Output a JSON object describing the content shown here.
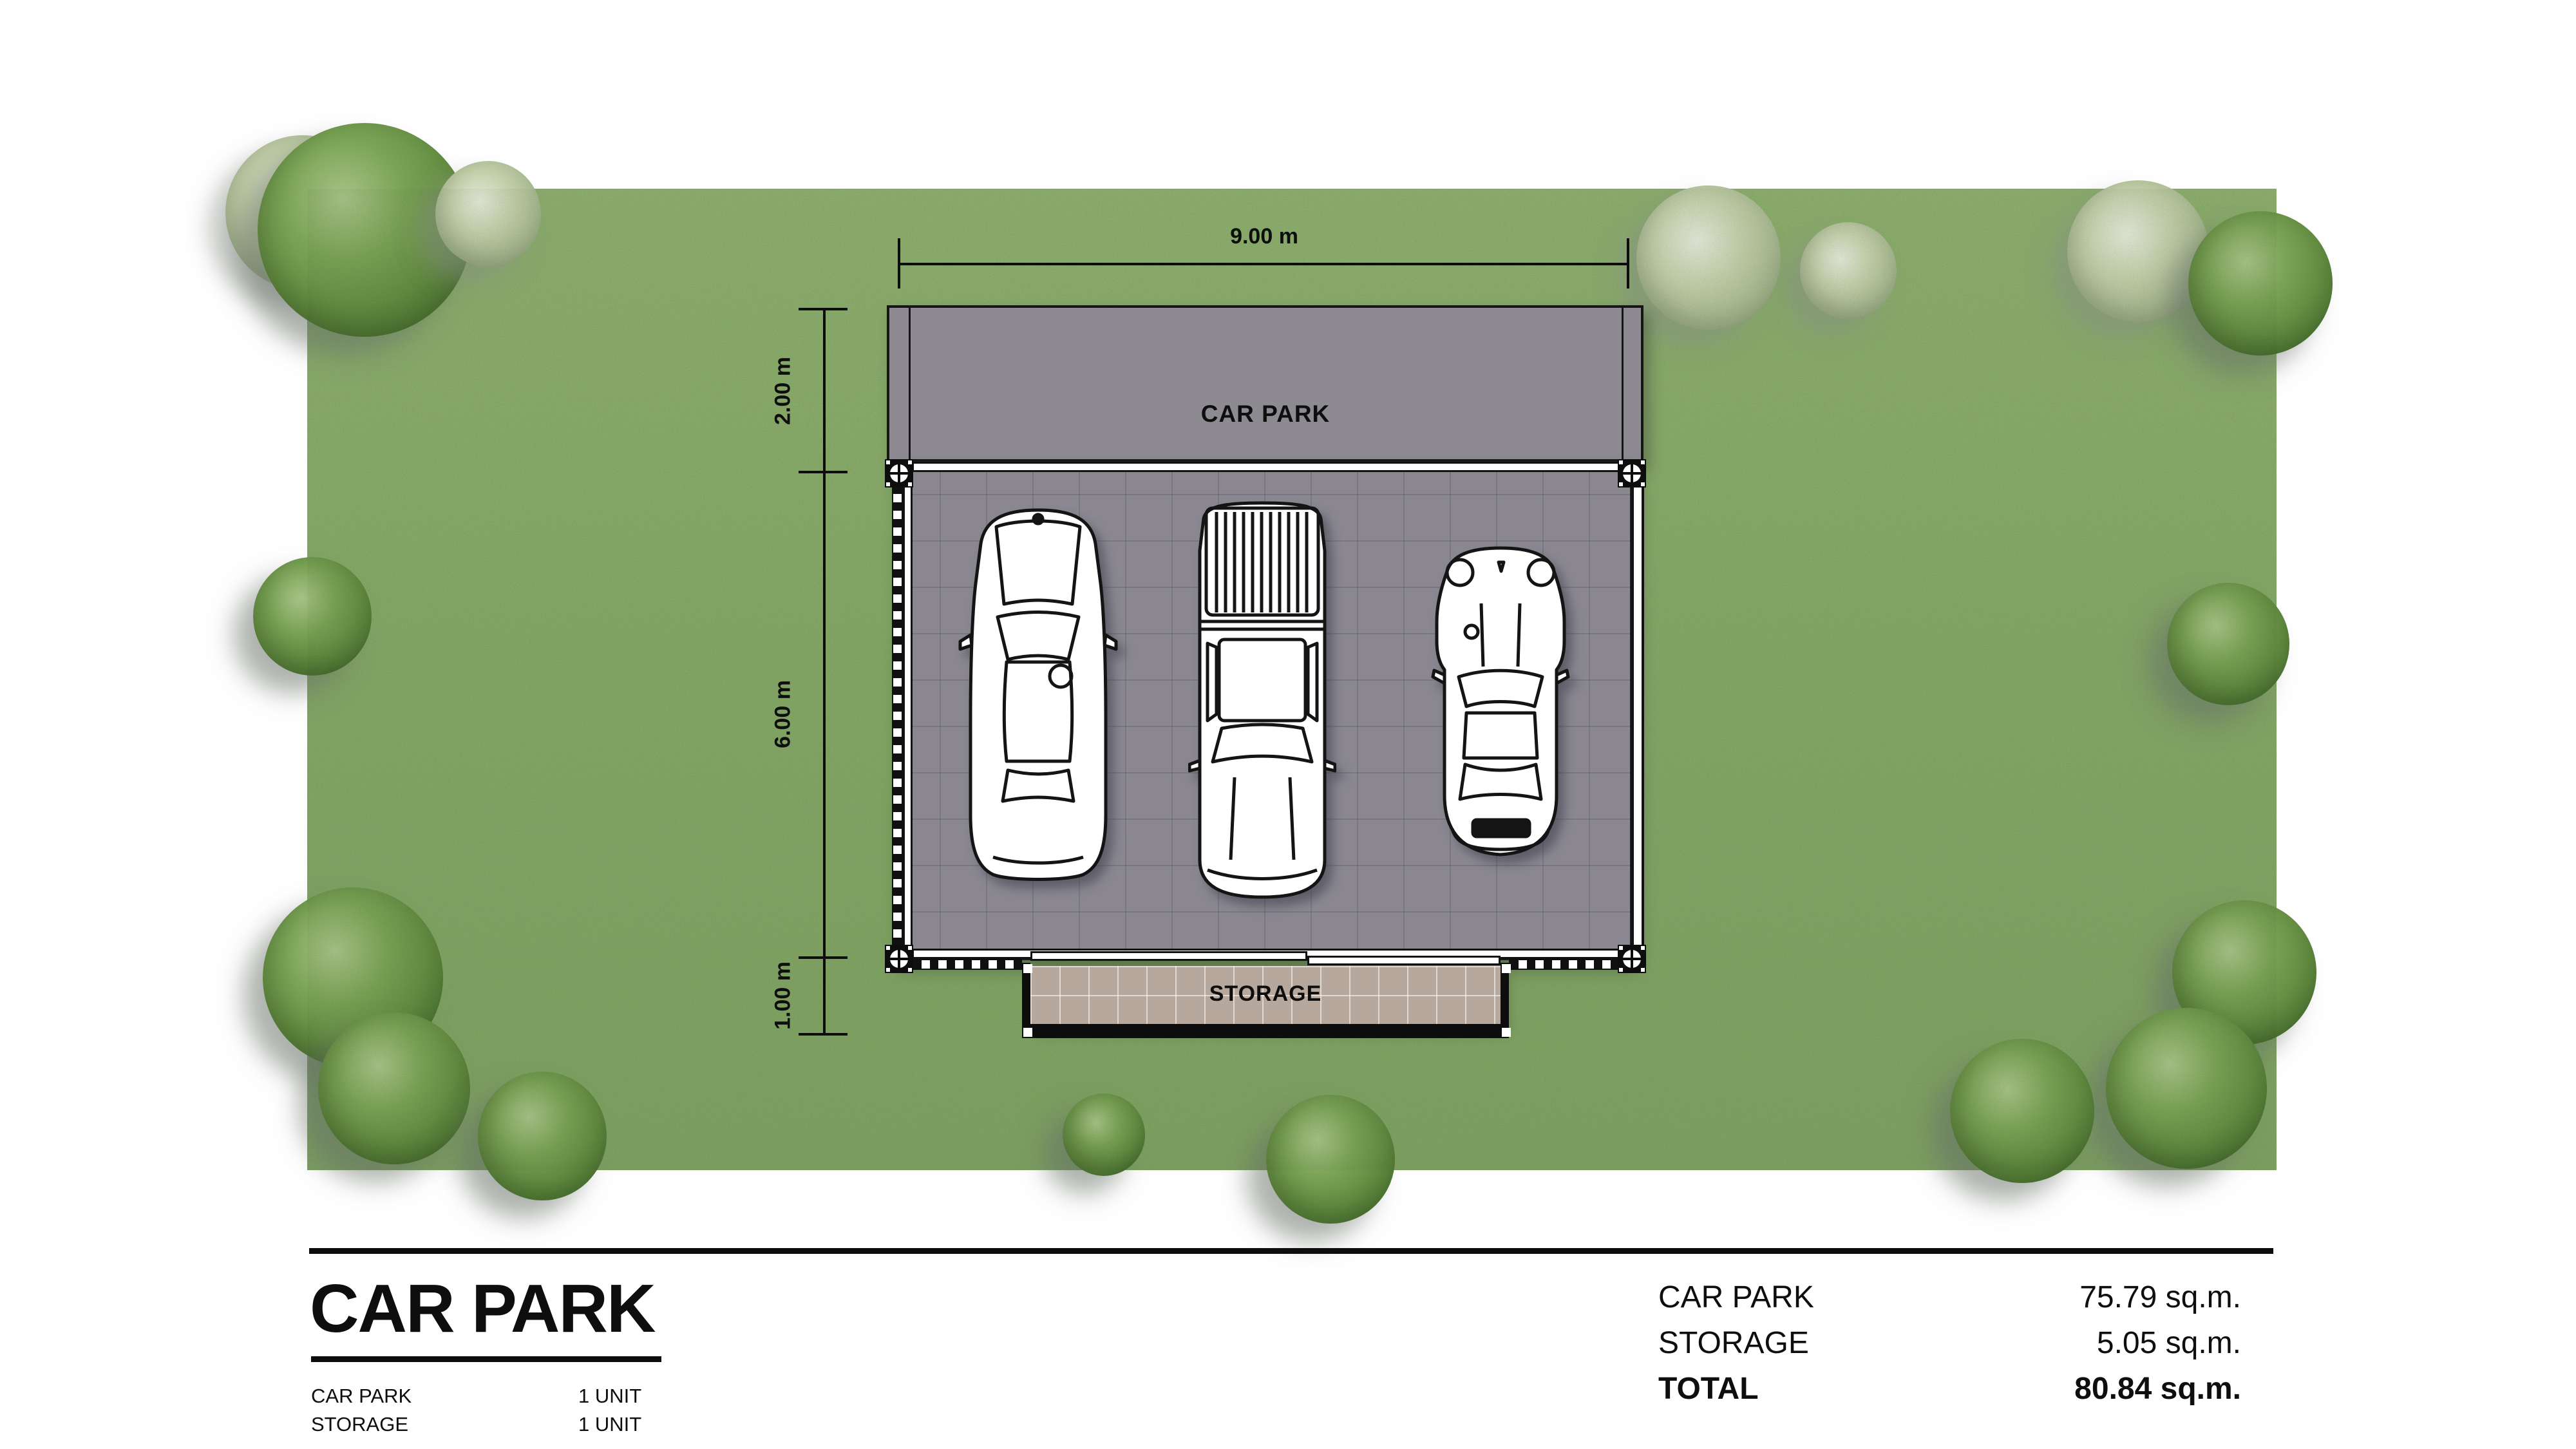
{
  "site_plan": {
    "top_dimension": "9.00 m",
    "left_dimensions": [
      "2.00 m",
      "6.00 m",
      "1.00 m"
    ],
    "car_park_label": "CAR PARK",
    "storage_label": "STORAGE"
  },
  "title_block": {
    "title": "CAR PARK",
    "legend": [
      {
        "label": "CAR PARK",
        "value": "1 UNIT"
      },
      {
        "label": "STORAGE",
        "value": "1 UNIT"
      }
    ]
  },
  "area_table": {
    "rows": [
      {
        "label": "CAR PARK",
        "value": "75.79 sq.m."
      },
      {
        "label": "STORAGE",
        "value": "5.05 sq.m."
      },
      {
        "label": "TOTAL",
        "value": "80.84 sq.m."
      }
    ]
  },
  "icons": {
    "column_marker": "column-symbol-circle-cross",
    "car_1": "sedan-top-view",
    "car_2": "pickup-truck-top-view",
    "car_3": "sports-car-top-view",
    "tree": "tree-canopy-top-view"
  },
  "colors": {
    "lawn": "#84a766",
    "roof_band": "#8d8a91",
    "slab": "#8a8790",
    "storage_tile": "#b7a89e",
    "line": "#0d0d0d",
    "background": "#ffffff"
  }
}
